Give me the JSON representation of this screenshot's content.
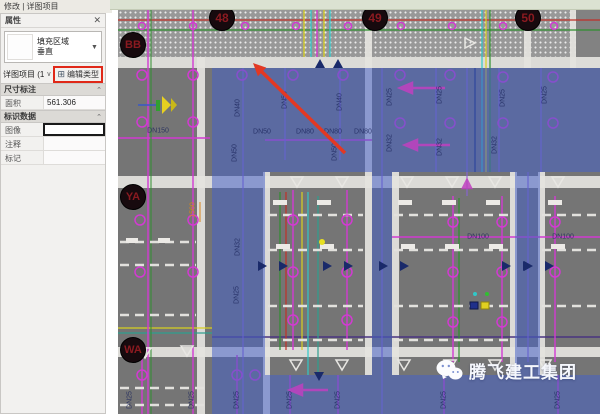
{
  "modify_bar": {
    "label": "修改 | 详图项目"
  },
  "properties_panel": {
    "title": "属性",
    "close_icon": "✕",
    "type_selector": {
      "family": "填充区域",
      "type_name": "垂直"
    },
    "selection_label": "详图项目 (1)",
    "edit_type_button": "编辑类型",
    "sections": [
      {
        "title": "尺寸标注",
        "rows": [
          {
            "label": "面积",
            "value": "561.306"
          }
        ]
      },
      {
        "title": "标识数据",
        "rows": [
          {
            "label": "图像",
            "value": ""
          },
          {
            "label": "注释",
            "value": ""
          },
          {
            "label": "标记",
            "value": ""
          }
        ]
      }
    ]
  },
  "canvas": {
    "grid_bubbles_top": [
      {
        "label": "48",
        "x": 104
      },
      {
        "label": "49",
        "x": 257
      },
      {
        "label": "50",
        "x": 410
      }
    ],
    "grid_bubbles_left": [
      {
        "label": "BB",
        "y": 35
      },
      {
        "label": "YA",
        "y": 187
      },
      {
        "label": "WA",
        "y": 340
      }
    ],
    "pipe_labels": [
      {
        "text": "DN150",
        "x": 40,
        "y": 121,
        "rot": 0
      },
      {
        "text": "DN40",
        "x": 120,
        "y": 98,
        "rot": 90
      },
      {
        "text": "DN50",
        "x": 144,
        "y": 122,
        "rot": 0
      },
      {
        "text": "DN50",
        "x": 117,
        "y": 143,
        "rot": 90
      },
      {
        "text": "DN50",
        "x": 167,
        "y": 90,
        "rot": 90
      },
      {
        "text": "DN80",
        "x": 187,
        "y": 122,
        "rot": 0
      },
      {
        "text": "DN80",
        "x": 215,
        "y": 122,
        "rot": 0
      },
      {
        "text": "DN80",
        "x": 245,
        "y": 122,
        "rot": 0
      },
      {
        "text": "DN40",
        "x": 222,
        "y": 92,
        "rot": 90
      },
      {
        "text": "DN25",
        "x": 272,
        "y": 87,
        "rot": 90
      },
      {
        "text": "DN32",
        "x": 272,
        "y": 133,
        "rot": 90
      },
      {
        "text": "DN50",
        "x": 217,
        "y": 142,
        "rot": 90
      },
      {
        "text": "DN25",
        "x": 322,
        "y": 85,
        "rot": 90
      },
      {
        "text": "DN25",
        "x": 385,
        "y": 88,
        "rot": 90
      },
      {
        "text": "DN25",
        "x": 427,
        "y": 85,
        "rot": 90
      },
      {
        "text": "DN32",
        "x": 322,
        "y": 137,
        "rot": 90
      },
      {
        "text": "DN32",
        "x": 377,
        "y": 135,
        "rot": 90
      },
      {
        "text": "DN32",
        "x": 120,
        "y": 237,
        "rot": 90
      },
      {
        "text": "DN25",
        "x": 119,
        "y": 285,
        "rot": 90
      },
      {
        "text": "DN100",
        "x": 360,
        "y": 227,
        "rot": 0
      },
      {
        "text": "DN100",
        "x": 445,
        "y": 227,
        "rot": 0
      },
      {
        "text": "DN25",
        "x": 12,
        "y": 390,
        "rot": 90
      },
      {
        "text": "DN25",
        "x": 74,
        "y": 390,
        "rot": 90
      },
      {
        "text": "DN25",
        "x": 119,
        "y": 390,
        "rot": 90
      },
      {
        "text": "DN25",
        "x": 172,
        "y": 390,
        "rot": 90
      },
      {
        "text": "DN25",
        "x": 220,
        "y": 390,
        "rot": 90
      },
      {
        "text": "DN25",
        "x": 326,
        "y": 390,
        "rot": 90
      },
      {
        "text": "DN25",
        "x": 440,
        "y": 390,
        "rot": 90
      }
    ],
    "dimension_labels": [
      {
        "text": "1560",
        "x": 75,
        "y": 200,
        "rot": 90,
        "color": "#d8861c"
      }
    ],
    "watermark": {
      "text": "腾飞建工集团"
    }
  },
  "colors": {
    "selection_blue": "#4662c8",
    "highlight_red": "#e02818",
    "grid_bubble_text": "#8b1a20",
    "magenta": "#d23ad2",
    "canvas_gray": "#757575"
  }
}
